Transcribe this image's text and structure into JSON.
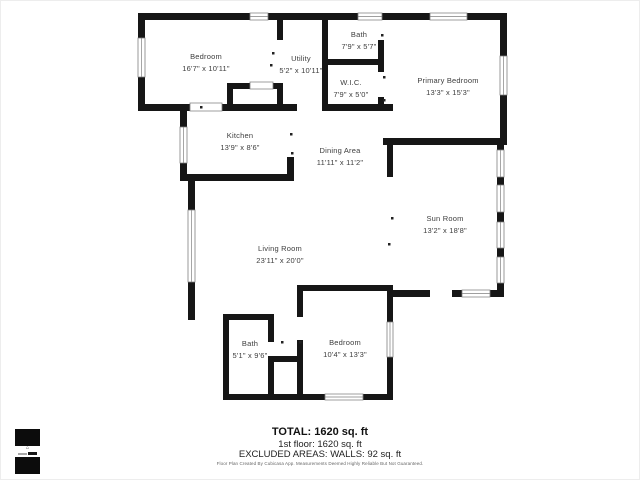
{
  "floorplan": {
    "rooms": [
      {
        "name": "Bedroom",
        "dims": "16'7\" x 10'11\""
      },
      {
        "name": "Utility",
        "dims": "5'2\" x 10'11\""
      },
      {
        "name": "Bath",
        "dims": "7'9\" x 5'7\""
      },
      {
        "name": "W.I.C.",
        "dims": "7'9\" x 5'0\""
      },
      {
        "name": "Primary Bedroom",
        "dims": "13'3\" x 15'3\""
      },
      {
        "name": "Kitchen",
        "dims": "13'9\" x 8'6\""
      },
      {
        "name": "Dining Area",
        "dims": "11'11\" x 11'2\""
      },
      {
        "name": "Sun Room",
        "dims": "13'2\" x 18'8\""
      },
      {
        "name": "Living Room",
        "dims": "23'11\" x 20'0\""
      },
      {
        "name": "Bath",
        "dims": "5'1\" x 9'6\""
      },
      {
        "name": "Bedroom",
        "dims": "10'4\" x 13'3\""
      }
    ],
    "colors": {
      "wall": "#161616",
      "window_stroke": "#808080",
      "background": "#ffffff"
    }
  },
  "summary": {
    "total": "TOTAL: 1620 sq. ft",
    "first_floor": "1st floor: 1620 sq. ft",
    "excluded": "EXCLUDED AREAS: WALLS: 92 sq. ft",
    "disclaimer": "Floor Plan Created By Cubicasa App. Measurements Deemed Highly Reliable But Not Guaranteed."
  },
  "logo": {
    "house_glyph": "⌂"
  }
}
